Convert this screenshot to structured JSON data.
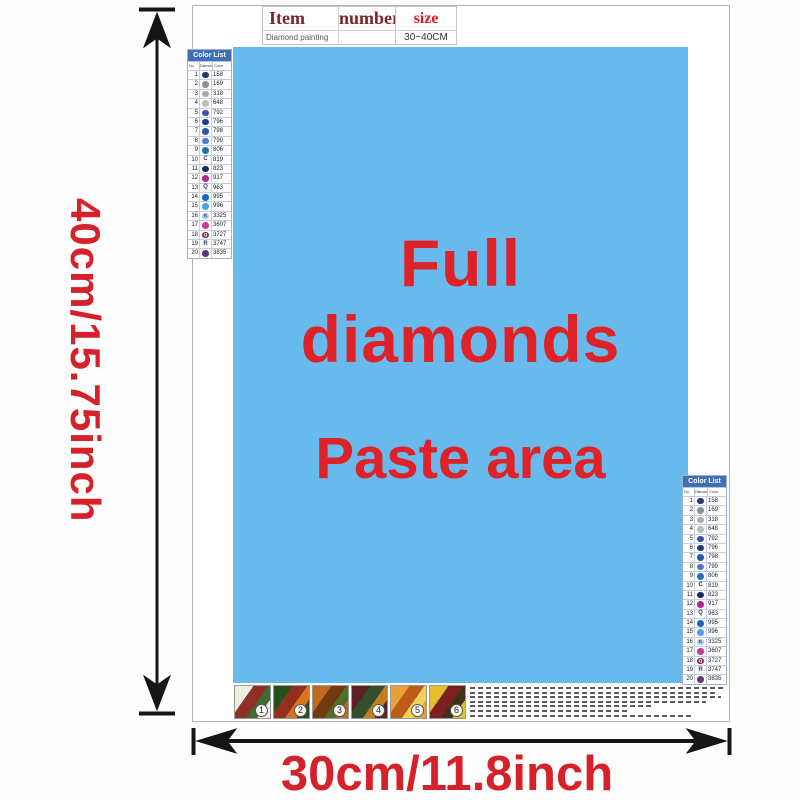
{
  "colors": {
    "paste_area_bg": "#68baed",
    "red_text": "#d6212a",
    "color_list_header_bg": "#3f6fb5",
    "item_header_text": "#7e2227",
    "size_header_text": "#e01b22",
    "arrow": "#151515"
  },
  "dimensions": {
    "height_label": "40cm/15.75inch",
    "width_label": "30cm/11.8inch"
  },
  "item_table": {
    "headers": [
      "Item",
      "number",
      "size"
    ],
    "row": [
      "Diamond painting",
      "",
      "30~40CM"
    ]
  },
  "paste_area": {
    "line1": "Full diamonds",
    "line2": "Paste area"
  },
  "color_list": {
    "title": "Color List",
    "columns": [
      "No.",
      "Diamond",
      "Color"
    ],
    "rows": [
      {
        "no": "1",
        "code": "158",
        "dot": "#27386e"
      },
      {
        "no": "2",
        "code": "169",
        "dot": "#8a8f98"
      },
      {
        "no": "3",
        "code": "318",
        "dot": "#a7abb0"
      },
      {
        "no": "4",
        "code": "648",
        "dot": "#b9bcb4"
      },
      {
        "no": "5",
        "code": "792",
        "dot": "#3c55a0"
      },
      {
        "no": "6",
        "code": "796",
        "dot": "#1f3a8c"
      },
      {
        "no": "7",
        "code": "798",
        "dot": "#2d54ae"
      },
      {
        "no": "8",
        "code": "799",
        "dot": "#5578c6"
      },
      {
        "no": "9",
        "code": "806",
        "dot": "#2371ae"
      },
      {
        "no": "10",
        "code": "819",
        "symbol": "C"
      },
      {
        "no": "11",
        "code": "823",
        "dot": "#1c2a5c"
      },
      {
        "no": "12",
        "code": "917",
        "dot": "#b1268e"
      },
      {
        "no": "13",
        "code": "963",
        "symbol": "Q"
      },
      {
        "no": "14",
        "code": "995",
        "dot": "#1e63c2"
      },
      {
        "no": "15",
        "code": "996",
        "dot": "#4aa4e6"
      },
      {
        "no": "16",
        "code": "3325",
        "dot": "#a5c9e9",
        "symbol": "K",
        "symbol_color": "#23508e"
      },
      {
        "no": "17",
        "code": "3607",
        "dot": "#c43ba0"
      },
      {
        "no": "18",
        "code": "3727",
        "dot": "#7c3251",
        "symbol": "Q",
        "symbol_color": "#ffffff"
      },
      {
        "no": "19",
        "code": "3747",
        "symbol": "R"
      },
      {
        "no": "20",
        "code": "3835",
        "dot": "#5d3a74"
      }
    ]
  },
  "thumbnails": [
    {
      "label": "1",
      "colors": [
        "#efece4",
        "#8f3028",
        "#3e6b33"
      ]
    },
    {
      "label": "2",
      "colors": [
        "#24511f",
        "#93301c",
        "#d9731f"
      ]
    },
    {
      "label": "3",
      "colors": [
        "#c06a1d",
        "#6f3a10",
        "#4f6e27"
      ]
    },
    {
      "label": "4",
      "colors": [
        "#5c2027",
        "#32502a",
        "#c57d22"
      ]
    },
    {
      "label": "5",
      "colors": [
        "#e6a238",
        "#bd5c16",
        "#efd35e"
      ]
    },
    {
      "label": "6",
      "colors": [
        "#e3c02f",
        "#7c2020",
        "#40301c"
      ]
    }
  ]
}
